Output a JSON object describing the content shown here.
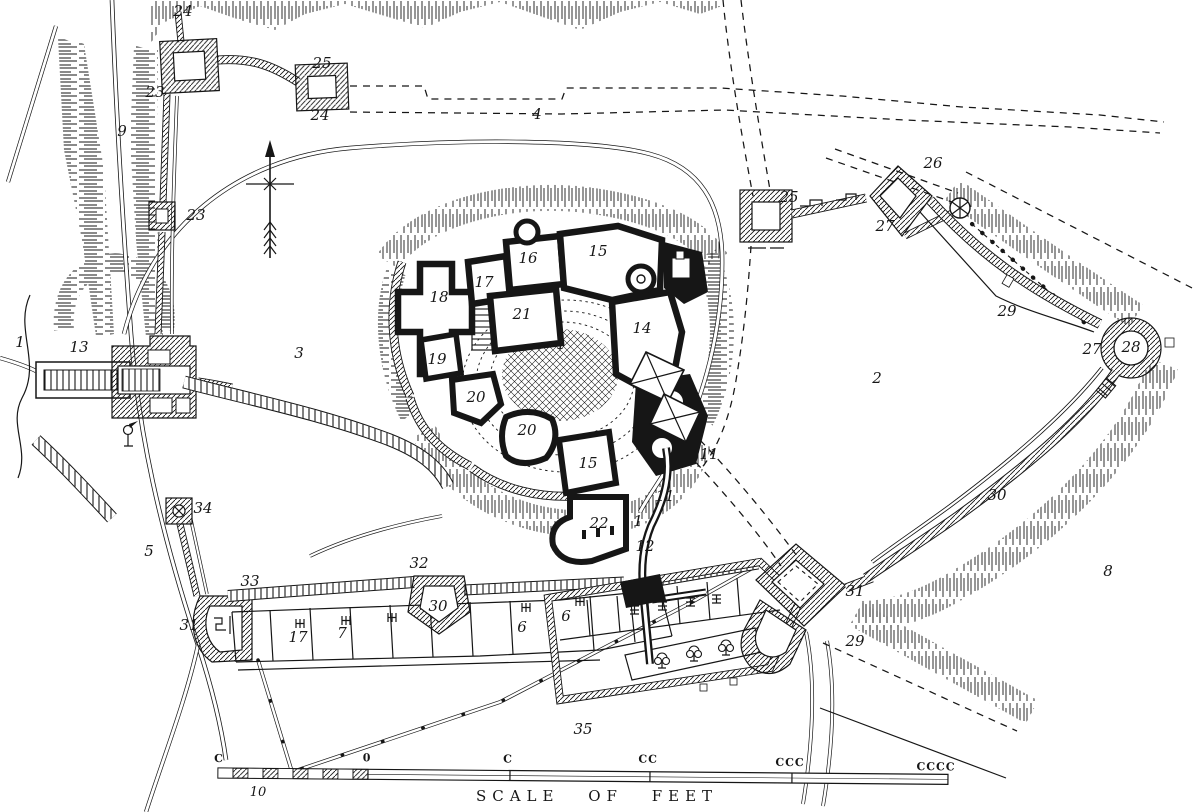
{
  "page": {
    "background": "#ffffff",
    "ink_color": "#161616"
  },
  "map": {
    "type": "engraved-castle-ground-plan",
    "labels": [
      {
        "t": "24",
        "x": 183,
        "y": 16
      },
      {
        "t": "25",
        "x": 322,
        "y": 68
      },
      {
        "t": "24",
        "x": 320,
        "y": 120
      },
      {
        "t": "23",
        "x": 155,
        "y": 97,
        "s": 13
      },
      {
        "t": "9",
        "x": 122,
        "y": 136
      },
      {
        "t": "23",
        "x": 196,
        "y": 220,
        "s": 14
      },
      {
        "t": "4",
        "x": 537,
        "y": 119
      },
      {
        "t": "26",
        "x": 933,
        "y": 168
      },
      {
        "t": "25",
        "x": 789,
        "y": 202
      },
      {
        "t": "27",
        "x": 885,
        "y": 231
      },
      {
        "t": "29",
        "x": 1007,
        "y": 316
      },
      {
        "t": "27",
        "x": 1092,
        "y": 354
      },
      {
        "t": "28",
        "x": 1131,
        "y": 352
      },
      {
        "t": "2",
        "x": 877,
        "y": 383
      },
      {
        "t": "1",
        "x": 20,
        "y": 347
      },
      {
        "t": "13",
        "x": 79,
        "y": 352
      },
      {
        "t": "3",
        "x": 299,
        "y": 358
      },
      {
        "t": "18",
        "x": 439,
        "y": 302
      },
      {
        "t": "17",
        "x": 484,
        "y": 287
      },
      {
        "t": "16",
        "x": 528,
        "y": 263
      },
      {
        "t": "15",
        "x": 598,
        "y": 256
      },
      {
        "t": "21",
        "x": 522,
        "y": 319
      },
      {
        "t": "14",
        "x": 642,
        "y": 333
      },
      {
        "t": "1",
        "x": 561,
        "y": 349,
        "s": 14
      },
      {
        "t": "19",
        "x": 437,
        "y": 364
      },
      {
        "t": "20",
        "x": 476,
        "y": 402
      },
      {
        "t": "20",
        "x": 527,
        "y": 435
      },
      {
        "t": "15",
        "x": 588,
        "y": 468
      },
      {
        "t": "22",
        "x": 599,
        "y": 528
      },
      {
        "t": "11",
        "x": 709,
        "y": 459,
        "s": 13
      },
      {
        "t": "11",
        "x": 665,
        "y": 501,
        "s": 13
      },
      {
        "t": "1",
        "x": 638,
        "y": 526,
        "s": 13
      },
      {
        "t": "12",
        "x": 645,
        "y": 551,
        "s": 13
      },
      {
        "t": "34",
        "x": 203,
        "y": 513,
        "s": 13
      },
      {
        "t": "5",
        "x": 149,
        "y": 556
      },
      {
        "t": "33",
        "x": 250,
        "y": 586
      },
      {
        "t": "32",
        "x": 419,
        "y": 568
      },
      {
        "t": "31",
        "x": 189,
        "y": 630
      },
      {
        "t": "30",
        "x": 438,
        "y": 611
      },
      {
        "t": "17",
        "x": 298,
        "y": 642,
        "s": 13
      },
      {
        "t": "7",
        "x": 342,
        "y": 638,
        "s": 13
      },
      {
        "t": "6",
        "x": 522,
        "y": 632,
        "s": 12
      },
      {
        "t": "6",
        "x": 566,
        "y": 621
      },
      {
        "t": "30",
        "x": 997,
        "y": 500
      },
      {
        "t": "31",
        "x": 855,
        "y": 596
      },
      {
        "t": "29",
        "x": 855,
        "y": 646
      },
      {
        "t": "8",
        "x": 1108,
        "y": 576
      },
      {
        "t": "35",
        "x": 583,
        "y": 734
      }
    ],
    "scale_bar": {
      "ticks": [
        {
          "t": "C",
          "x": 219,
          "y": 762
        },
        {
          "t": "0",
          "x": 367,
          "y": 760
        },
        {
          "t": "C",
          "x": 508,
          "y": 760
        },
        {
          "t": "CC",
          "x": 648,
          "y": 759
        },
        {
          "t": "CCC",
          "x": 790,
          "y": 761
        },
        {
          "t": "CCCC",
          "x": 936,
          "y": 764
        }
      ],
      "sub_label": {
        "t": "10",
        "x": 258,
        "y": 796
      },
      "caption": {
        "t": "SCALE OF FEET",
        "x": 597,
        "y": 801
      }
    }
  }
}
